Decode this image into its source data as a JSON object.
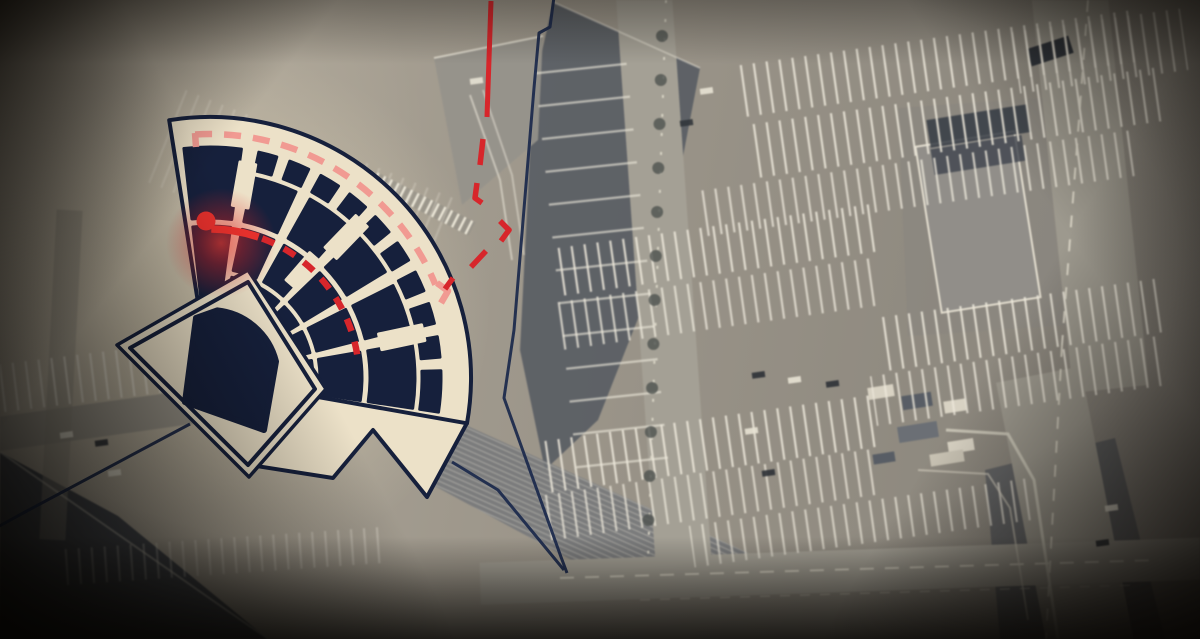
{
  "scene": {
    "type": "annotated-satellite-map",
    "subject": "concert-hall attack-route news graphic",
    "width": 1200,
    "height": 639
  },
  "colors": {
    "navy": "#16203c",
    "navy_outline": "#1d2b4d",
    "cream": "#ece1c8",
    "red": "#d7262b",
    "red_bright": "#e4302c",
    "salmon": "#f19a92",
    "glow_red": "#e02525",
    "sat_light": "#b3ab9c",
    "sat_mid": "#999387",
    "sat_roof": "#575c64",
    "stripe": "#eee8d8"
  },
  "hall": {
    "center": [
      210,
      378
    ],
    "outer_radius": 261,
    "inner_radius": 26,
    "angle_start": -99,
    "angle_end": 10,
    "rings": [
      {
        "name": "parterre-front",
        "r": [
          66,
          103
        ],
        "segments": [
          [
            -77.8,
            -65.2
          ],
          [
            -60.8,
            -48.2
          ],
          [
            -43.8,
            -31.2
          ],
          [
            -26.8,
            -14.2
          ],
          [
            -9.8,
            8.5
          ]
        ]
      },
      {
        "name": "parterre-mid",
        "r": [
          110,
          152
        ],
        "segments": [
          [
            -77.8,
            -65.2
          ],
          [
            -60.8,
            -48.2
          ],
          [
            -43.8,
            -31.2
          ],
          [
            -26.8,
            -14.2
          ],
          [
            -9.8,
            8.5
          ]
        ]
      },
      {
        "name": "parterre-rear",
        "r": [
          160,
          205
        ],
        "segments": [
          [
            -77.8,
            -65.2
          ],
          [
            -60.8,
            -48.2
          ],
          [
            -43.8,
            -31.2
          ],
          [
            -26.8,
            -14.2
          ],
          [
            -9.8,
            8.5
          ]
        ]
      },
      {
        "name": "left-block-lower",
        "r": [
          66,
          152
        ],
        "segments": [
          [
            -96.5,
            -82.2
          ]
        ]
      },
      {
        "name": "left-block-upper",
        "r": [
          160,
          231
        ],
        "segments": [
          [
            -96.5,
            -82.2
          ]
        ]
      },
      {
        "name": "balcony",
        "r": [
          212,
          231
        ],
        "segments": [
          [
            -77.8,
            -73.2
          ],
          [
            -69.8,
            -64.7
          ],
          [
            -61.3,
            -56.2
          ],
          [
            -52.8,
            -47.7
          ],
          [
            -44.3,
            -39.2
          ],
          [
            -35.8,
            -30.7
          ],
          [
            -27.3,
            -22.2
          ],
          [
            -18.8,
            -13.7
          ],
          [
            -10.3,
            -5.2
          ],
          [
            -1.8,
            8.5
          ]
        ]
      }
    ],
    "tabs": [
      {
        "r": 196,
        "a": -80,
        "w": 16,
        "h": 44
      },
      {
        "r": 196,
        "a": -46,
        "w": 16,
        "h": 44
      },
      {
        "r": 196,
        "a": -12,
        "w": 16,
        "h": 44
      },
      {
        "r": 142,
        "a": -49,
        "w": 14,
        "h": 36
      }
    ],
    "snout": [
      [
        467,
        423
      ],
      [
        427,
        497
      ],
      [
        373,
        430
      ],
      [
        333,
        478
      ],
      [
        250,
        465
      ],
      [
        285,
        378
      ],
      [
        440,
        385
      ]
    ],
    "stage_pad_outer": [
      [
        248,
        270
      ],
      [
        326,
        389
      ],
      [
        249,
        477
      ],
      [
        117,
        345
      ]
    ],
    "stage_pad": [
      [
        248,
        282
      ],
      [
        315,
        389
      ],
      [
        248,
        465
      ],
      [
        130,
        348
      ]
    ],
    "stage": {
      "arc_r": 68,
      "arc_a": [
        -84,
        -14
      ],
      "pts": [
        [
          264,
          430
        ],
        [
          185,
          402
        ],
        [
          196,
          318
        ]
      ]
    }
  },
  "route": {
    "approach_solid": [
      [
        491,
        1
      ],
      [
        487,
        117
      ]
    ],
    "approach_dashes": [
      [
        [
          483,
          139
        ],
        [
          480,
          165
        ]
      ],
      [
        [
          477,
          183
        ],
        [
          475,
          198
        ],
        [
          482,
          203
        ]
      ],
      [
        [
          500,
          221
        ],
        [
          509,
          230
        ],
        [
          501,
          241
        ]
      ],
      [
        [
          486,
          251
        ],
        [
          471,
          267
        ]
      ],
      [
        [
          453,
          278
        ],
        [
          445,
          289
        ]
      ]
    ],
    "corridor_arc": {
      "r": 244,
      "a": [
        -93.5,
        -22.5
      ],
      "dash": "17 12",
      "width": 6.5
    },
    "corridor_bends": [
      [
        [
          195,
          133
        ],
        [
          196,
          147
        ]
      ],
      [
        [
          437,
          283
        ],
        [
          448,
          291
        ],
        [
          441,
          303
        ]
      ]
    ],
    "hall_arc_solid": {
      "r": 149,
      "a": [
        -89.5,
        -71
      ],
      "width": 7.5
    },
    "hall_arc_dashed": {
      "r": 149,
      "a": [
        -69.5,
        -6
      ],
      "dash": "13 11",
      "width": 6.5
    },
    "marker": {
      "c": [
        206,
        221
      ],
      "r": 9.5
    },
    "glow": {
      "c": [
        221,
        243
      ],
      "r": 55
    }
  },
  "building_outline": [
    [
      [
        554,
        -3
      ],
      [
        550,
        27
      ],
      [
        539,
        33
      ],
      [
        534,
        88
      ],
      [
        514,
        330
      ],
      [
        504,
        398
      ],
      [
        561,
        557
      ],
      [
        567,
        573
      ]
    ],
    [
      [
        564,
        570
      ],
      [
        498,
        490
      ],
      [
        452,
        462
      ]
    ],
    [
      [
        190,
        424
      ],
      [
        25,
        512
      ],
      [
        -6,
        529
      ]
    ]
  ],
  "satellite": {
    "polys": [
      {
        "pts": [
          [
            553,
            2
          ],
          [
            700,
            68
          ],
          [
            665,
            250
          ],
          [
            598,
            420
          ],
          [
            545,
            470
          ],
          [
            520,
            350
          ],
          [
            533,
            92
          ]
        ],
        "f": "#575c64",
        "op": 0.9
      },
      {
        "pts": [
          [
            434,
            58
          ],
          [
            543,
            36
          ],
          [
            538,
            140
          ],
          [
            462,
            205
          ]
        ],
        "f": "#96928a",
        "op": 0.9
      },
      {
        "pts": [
          [
            388,
            390
          ],
          [
            755,
            556
          ],
          [
            590,
            570
          ],
          [
            405,
            470
          ]
        ],
        "f": "#74777a",
        "op": 0.85
      },
      {
        "pts": [
          [
            388,
            390
          ],
          [
            755,
            556
          ],
          [
            590,
            570
          ],
          [
            405,
            470
          ]
        ],
        "f": "url(#hatch)",
        "op": 0.9
      },
      {
        "pts": [
          [
            0,
            452
          ],
          [
            118,
            516
          ],
          [
            268,
            639
          ],
          [
            0,
            639
          ]
        ],
        "f": "#474b52",
        "op": 1
      },
      {
        "pts": [
          [
            985,
            470
          ],
          [
            1115,
            438
          ],
          [
            1165,
            639
          ],
          [
            1000,
            639
          ]
        ],
        "f": "#5a5c60",
        "op": 0.8
      },
      {
        "pts": [
          [
            898,
            108
          ],
          [
            1072,
            96
          ],
          [
            1086,
            324
          ],
          [
            908,
            336
          ]
        ],
        "f": "#8a867e",
        "op": 0.65
      }
    ],
    "rects": [
      {
        "x": 636,
        "y": -10,
        "w": 56,
        "h": 585,
        "rot": -4,
        "f": "#a5a093"
      },
      {
        "x": 1052,
        "y": -10,
        "w": 76,
        "h": 400,
        "rot": -6,
        "f": "#9e998c"
      },
      {
        "x": 1022,
        "y": 372,
        "w": 86,
        "h": 280,
        "rot": -11,
        "f": "#9e998c"
      },
      {
        "x": 480,
        "y": 550,
        "w": 730,
        "h": 42,
        "rot": -2,
        "f": "#a5a093"
      },
      {
        "x": -10,
        "y": 388,
        "w": 430,
        "h": 34,
        "rot": -8,
        "f": "#9e988b"
      },
      {
        "x": 48,
        "y": 210,
        "w": 26,
        "h": 330,
        "rot": 3,
        "f": "#958f82",
        "op": 0.5
      },
      {
        "x": 928,
        "y": 138,
        "w": 100,
        "h": 168,
        "rot": -9,
        "f": "#918e88",
        "s": "#e3dccb",
        "sw": 2
      },
      {
        "x": 928,
        "y": 112,
        "w": 102,
        "h": 28,
        "rot": -9,
        "f": "#353c46",
        "op": 0.85
      },
      {
        "x": 932,
        "y": 142,
        "w": 92,
        "h": 26,
        "rot": -9,
        "f": "#3d444f",
        "op": 0.8
      },
      {
        "x": 1028,
        "y": 42,
        "w": 44,
        "h": 18,
        "rot": -18,
        "f": "#2e333a"
      },
      {
        "x": 366,
        "y": 196,
        "w": 112,
        "h": 15,
        "rot": 27,
        "f": "url(#rungs)"
      },
      {
        "x": 385,
        "y": 248,
        "w": 64,
        "h": 12,
        "rot": 27,
        "f": "url(#rungs)"
      },
      {
        "x": 868,
        "y": 386,
        "w": 26,
        "h": 12,
        "rot": -9,
        "f": "#d9d2c0"
      },
      {
        "x": 902,
        "y": 394,
        "w": 30,
        "h": 14,
        "rot": -9,
        "f": "#575d66"
      },
      {
        "x": 944,
        "y": 400,
        "w": 22,
        "h": 12,
        "rot": -9,
        "f": "#d9d2c0"
      },
      {
        "x": 898,
        "y": 424,
        "w": 40,
        "h": 16,
        "rot": -9,
        "f": "#6a6f76"
      },
      {
        "x": 948,
        "y": 440,
        "w": 26,
        "h": 12,
        "rot": -9,
        "f": "#d9d2c0"
      },
      {
        "x": 873,
        "y": 453,
        "w": 22,
        "h": 10,
        "rot": -9,
        "f": "#575d66"
      },
      {
        "x": 930,
        "y": 452,
        "w": 34,
        "h": 12,
        "rot": -9,
        "f": "#c9c2b0"
      }
    ],
    "bands": [
      {
        "x": 735,
        "y": 38,
        "w": 400,
        "h": 52,
        "rot": -8,
        "p": "pv"
      },
      {
        "x": 745,
        "y": 96,
        "w": 420,
        "h": 54,
        "rot": -8,
        "p": "pv"
      },
      {
        "x": 700,
        "y": 160,
        "w": 440,
        "h": 46,
        "rot": -8,
        "p": "pv",
        "op": 0.9
      },
      {
        "x": 556,
        "y": 226,
        "w": 320,
        "h": 48,
        "rot": -8,
        "p": "pv"
      },
      {
        "x": 552,
        "y": 280,
        "w": 330,
        "h": 48,
        "rot": -8,
        "p": "pv",
        "op": 0.9
      },
      {
        "x": 880,
        "y": 298,
        "w": 280,
        "h": 54,
        "rot": -8,
        "p": "pv"
      },
      {
        "x": 872,
        "y": 356,
        "w": 290,
        "h": 50,
        "rot": -8,
        "p": "pv",
        "op": 0.9
      },
      {
        "x": 545,
        "y": 418,
        "w": 330,
        "h": 52,
        "rot": -8,
        "p": "pv"
      },
      {
        "x": 540,
        "y": 472,
        "w": 340,
        "h": 46,
        "rot": -8,
        "p": "pv",
        "op": 0.85
      },
      {
        "x": 1015,
        "y": 20,
        "w": 170,
        "h": 62,
        "rot": -8,
        "p": "pv",
        "op": 0.9
      },
      {
        "x": 556,
        "y": 55,
        "w": 92,
        "h": 430,
        "rot": -6,
        "p": "ph",
        "op": 0.8
      },
      {
        "x": 0,
        "y": 346,
        "w": 300,
        "h": 48,
        "rot": -7,
        "p": "pv",
        "op": 0.7
      },
      {
        "x": 150,
        "y": 140,
        "w": 300,
        "h": 100,
        "rot": 22,
        "p": "pv",
        "op": 0.3
      },
      {
        "x": 690,
        "y": 502,
        "w": 340,
        "h": 42,
        "rot": -8,
        "p": "pv",
        "op": 0.8
      },
      {
        "x": 60,
        "y": 538,
        "w": 330,
        "h": 36,
        "rot": -4,
        "p": "pv",
        "op": 0.4
      }
    ],
    "lines": [
      {
        "pts": [
          [
            666,
            0
          ],
          [
            648,
            560
          ]
        ],
        "s": "#ded8c6",
        "w": 2,
        "dash": "3 16",
        "op": 0.9
      },
      {
        "pts": [
          [
            1088,
            0
          ],
          [
            1062,
            345
          ]
        ],
        "s": "#ded8c6",
        "w": 2,
        "dash": "12 12",
        "op": 0.9
      },
      {
        "pts": [
          [
            1062,
            345
          ],
          [
            1046,
            639
          ]
        ],
        "s": "#ded8c6",
        "w": 2,
        "dash": "12 12",
        "op": 0.8
      },
      {
        "pts": [
          [
            560,
            578
          ],
          [
            1160,
            560
          ]
        ],
        "s": "#ded8c6",
        "w": 2,
        "dash": "14 11",
        "op": 0.85
      },
      {
        "pts": [
          [
            946,
            430
          ],
          [
            1008,
            434
          ],
          [
            1034,
            480
          ],
          [
            1058,
            639
          ]
        ],
        "s": "#d5cfbd",
        "w": 3,
        "op": 0.8
      },
      {
        "pts": [
          [
            918,
            470
          ],
          [
            988,
            474
          ],
          [
            1010,
            508
          ],
          [
            1028,
            620
          ]
        ],
        "s": "#d5cfbd",
        "w": 2,
        "op": 0.6
      },
      {
        "pts": [
          [
            553,
            2
          ],
          [
            700,
            68
          ]
        ],
        "s": "#e8e2d2",
        "w": 2,
        "op": 0.5
      },
      {
        "pts": [
          [
            434,
            58
          ],
          [
            543,
            36
          ]
        ],
        "s": "#efe9d9",
        "w": 2,
        "op": 0.7
      },
      {
        "pts": [
          [
            0,
            452
          ],
          [
            268,
            639
          ]
        ],
        "s": "#d8d2c0",
        "w": 2,
        "op": 0.5
      },
      {
        "pts": [
          [
            640,
            600
          ],
          [
            1140,
            585
          ]
        ],
        "s": "#cfc9b7",
        "w": 1.5,
        "dash": "10 10",
        "op": 0.5
      },
      {
        "pts": [
          [
            470,
            95
          ],
          [
            500,
            180
          ],
          [
            512,
            260
          ]
        ],
        "s": "#efe9d9",
        "w": 2,
        "op": 0.55
      },
      {
        "pts": [
          [
            483,
            90
          ],
          [
            512,
            175
          ],
          [
            524,
            255
          ]
        ],
        "s": "#efe9d9",
        "w": 2,
        "op": 0.45
      }
    ],
    "tree_column": {
      "x0": 662,
      "y0": 36,
      "y1": 530,
      "step": 44,
      "r": 6,
      "f": "#4e524f",
      "op": 0.8
    },
    "cars": [
      {
        "x": 752,
        "y": 372,
        "f": "#2c3137"
      },
      {
        "x": 788,
        "y": 377,
        "f": "#e9e3d1"
      },
      {
        "x": 826,
        "y": 381,
        "f": "#2c3137"
      },
      {
        "x": 745,
        "y": 428,
        "f": "#e9e3d1"
      },
      {
        "x": 762,
        "y": 470,
        "f": "#2c3137"
      },
      {
        "x": 700,
        "y": 88,
        "f": "#e9e3d1"
      },
      {
        "x": 680,
        "y": 120,
        "f": "#31363c"
      },
      {
        "x": 60,
        "y": 432,
        "f": "#e9e3d1"
      },
      {
        "x": 95,
        "y": 440,
        "f": "#2c3137"
      },
      {
        "x": 1105,
        "y": 505,
        "f": "#e9e3d1"
      },
      {
        "x": 1096,
        "y": 540,
        "f": "#2c3137"
      },
      {
        "x": 470,
        "y": 78,
        "f": "#e9e3d1"
      },
      {
        "x": 140,
        "y": 332,
        "f": "#e9e3d1"
      },
      {
        "x": 148,
        "y": 362,
        "f": "#31363c"
      },
      {
        "x": 108,
        "y": 470,
        "f": "#e9e3d1"
      }
    ]
  }
}
